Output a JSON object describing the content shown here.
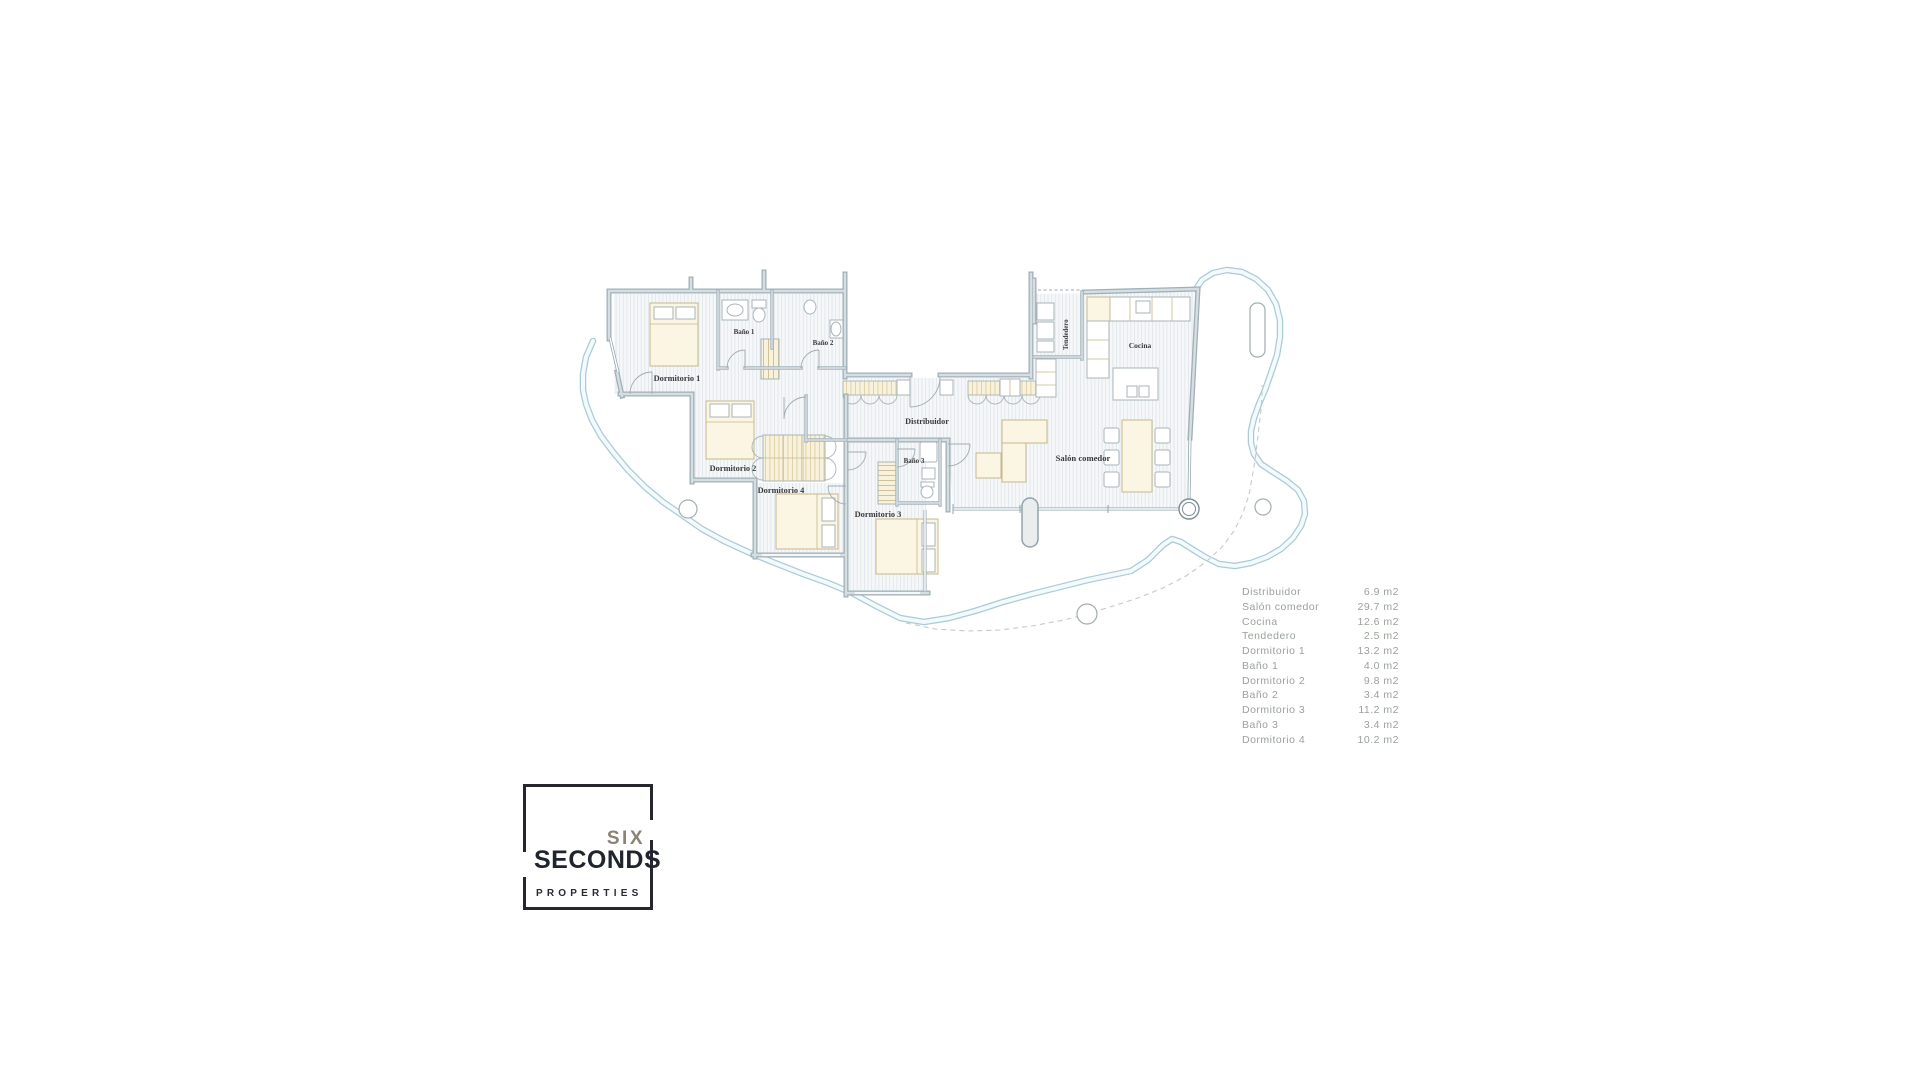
{
  "plan": {
    "labels": {
      "dormitorio1": "Dormitorio 1",
      "bano1": "Baño 1",
      "bano2": "Baño 2",
      "dormitorio2": "Dormitorio 2",
      "dormitorio4": "Dormitorio 4",
      "dormitorio3": "Dormitorio 3",
      "bano3": "Baño 3",
      "distribuidor": "Distribuidor",
      "salon": "Salón comedor",
      "cocina": "Cocina",
      "tendedero": "Tendedero"
    }
  },
  "legend": {
    "rows": [
      {
        "name": "Distribuidor",
        "area": "6.9 m2"
      },
      {
        "name": "Salón comedor",
        "area": "29.7 m2"
      },
      {
        "name": "Cocina",
        "area": "12.6 m2"
      },
      {
        "name": "Tendedero",
        "area": "2.5 m2"
      },
      {
        "name": "Dormitorio 1",
        "area": "13.2 m2"
      },
      {
        "name": "Baño 1",
        "area": "4.0 m2"
      },
      {
        "name": "Dormitorio 2",
        "area": "9.8 m2"
      },
      {
        "name": "Baño 2",
        "area": "3.4 m2"
      },
      {
        "name": "Dormitorio 3",
        "area": "11.2 m2"
      },
      {
        "name": "Baño 3",
        "area": "3.4 m2"
      },
      {
        "name": "Dormitorio 4",
        "area": "10.2 m2"
      }
    ]
  },
  "logo": {
    "six": "SIX",
    "seconds": "SECONDS",
    "properties": "PROPERTIES"
  },
  "colors": {
    "wall": "#9fb0b8",
    "terrace_line": "#a9cbd8",
    "furniture_fill": "#fbf5e3",
    "furniture_stroke": "#c7b88c",
    "legend_text": "#9ba19b",
    "logo_dark": "#26262f",
    "logo_gray": "#8a8376"
  }
}
